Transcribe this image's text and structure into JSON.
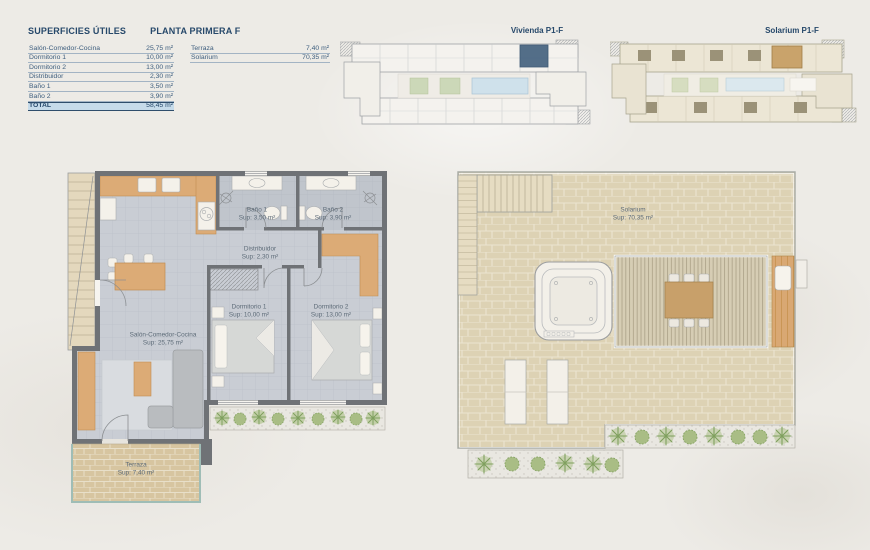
{
  "header": {
    "title": "SUPERFICIES ÚTILES",
    "subtitle": "PLANTA PRIMERA F"
  },
  "areas_table": {
    "rows": [
      {
        "label": "Salón-Comedor-Cocina",
        "value": "25,75 m²"
      },
      {
        "label": "Dormitorio 1",
        "value": "10,00 m²"
      },
      {
        "label": "Dormitorio 2",
        "value": "13,00 m²"
      },
      {
        "label": "Distribuidor",
        "value": "2,30 m²"
      },
      {
        "label": "Baño 1",
        "value": "3,50 m²"
      },
      {
        "label": "Baño 2",
        "value": "3,90 m²"
      }
    ],
    "total_label": "TOTAL",
    "total_value": "58,45 m²"
  },
  "exterior_table": {
    "rows": [
      {
        "label": "Terraza",
        "value": "7,40 m²"
      },
      {
        "label": "Solarium",
        "value": "70,35 m²"
      }
    ]
  },
  "key_plans": {
    "vivienda_label": "Vivienda P1-F",
    "solarium_label": "Solarium P1-F"
  },
  "vivienda_plan": {
    "rooms": {
      "bano1": {
        "name": "Baño 1",
        "sup": "Sup: 3,50 m²"
      },
      "bano2": {
        "name": "Baño 2",
        "sup": "Sup: 3,90 m²"
      },
      "distribuidor": {
        "name": "Distribuidor",
        "sup": "Sup: 2,30 m²"
      },
      "dormitorio1": {
        "name": "Dormitorio 1",
        "sup": "Sup: 10,00 m²"
      },
      "dormitorio2": {
        "name": "Dormitorio 2",
        "sup": "Sup: 13,00 m²"
      },
      "salon": {
        "name": "Salón-Comedor-Cocina",
        "sup": "Sup: 25,75 m²"
      },
      "terraza": {
        "name": "Terraza",
        "sup": "Sup: 7,40 m²"
      }
    }
  },
  "solarium_plan": {
    "rooms": {
      "solarium": {
        "name": "Solarium",
        "sup": "Sup: 70,35 m²"
      }
    }
  },
  "colors": {
    "navy": "#2e4d6b",
    "total_row_bg": "#c6dbea",
    "plan_text": "#5d6b78",
    "wall_gray": "#6f7276",
    "tile_floor": "#c9cdd4",
    "wood": "#dcab76",
    "terrace_brick": "#d7c5a0",
    "solarium_brick": "#ddd2b4",
    "plant_green": "#9ab37e",
    "pool_blue": "#cfe1eb",
    "railing_teal": "#9fbdb6",
    "highlight_unit_navy": "#42607e",
    "highlight_unit_tan": "#c9a36b"
  }
}
